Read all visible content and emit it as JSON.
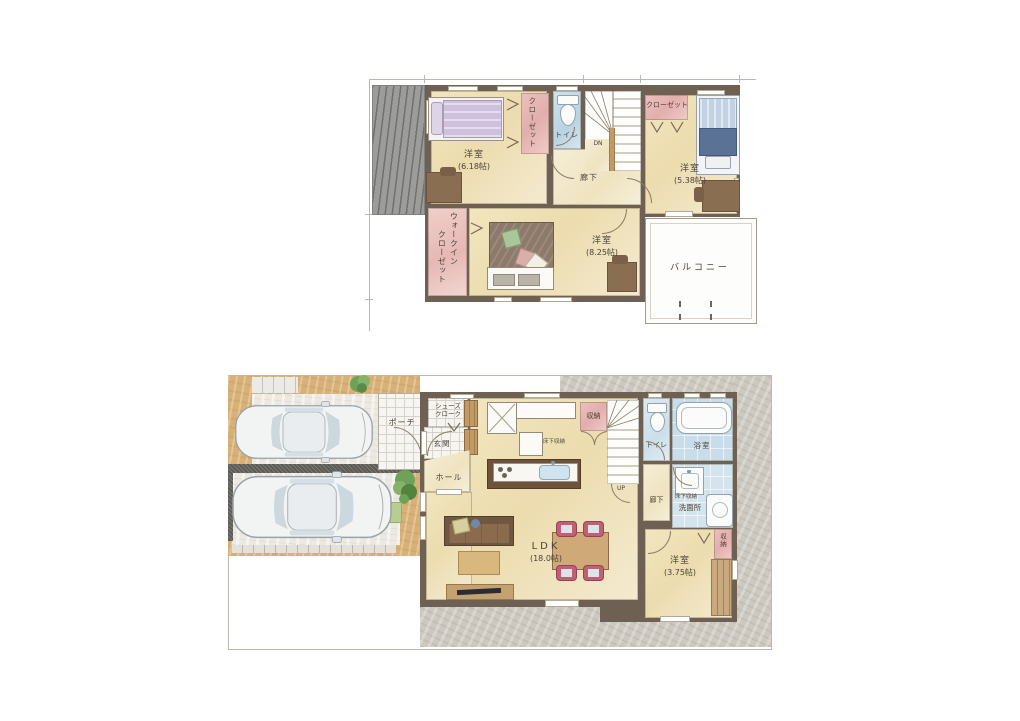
{
  "palette": {
    "wall": "#6e6053",
    "floor": "#f0e3b8",
    "pink": "#e7b8b5",
    "blue": "#c3d9e6",
    "tan": "#d8b178",
    "concrete": "#cdc9c1",
    "wood": "#c9a97e",
    "ink": "#4a4236",
    "chair": "#c06070",
    "balcony": "#fdfdfb"
  },
  "floor2": {
    "rooms": {
      "bedroom618": {
        "label": "洋室",
        "size": "(6.18帖)"
      },
      "closet_left": {
        "label": "クローゼット"
      },
      "toilet": {
        "label": "トイレ"
      },
      "stairs": {
        "label": "DN"
      },
      "hallway": {
        "label": "廊下"
      },
      "closet_right": {
        "label": "クローゼット"
      },
      "bedroom538": {
        "label": "洋室",
        "size": "(5.38帖)"
      },
      "wic": {
        "line1": "ウォークイン",
        "line2": "クローゼット"
      },
      "bedroom825": {
        "label": "洋室",
        "size": "(8.25帖)"
      },
      "balcony": {
        "label": "バルコニー"
      }
    }
  },
  "floor1": {
    "rooms": {
      "porch": {
        "label": "ポーチ"
      },
      "shoes_cloak": {
        "line1": "シューズ",
        "line2": "クローク"
      },
      "genkan": {
        "label": "玄関"
      },
      "hall": {
        "label": "ホール"
      },
      "kitchen_underfloor": {
        "label": "床下収納"
      },
      "storage_stairs": {
        "label": "収納"
      },
      "stairs": {
        "label": "UP"
      },
      "toilet": {
        "label": "トイレ"
      },
      "bath": {
        "label": "浴室"
      },
      "hallway": {
        "label": "廊下"
      },
      "washroom": {
        "label": "洗面所"
      },
      "washroom_underfloor": {
        "label": "床下収納"
      },
      "ldk": {
        "label": "LDK",
        "size": "(18.0帖)"
      },
      "bedroom375": {
        "label": "洋室",
        "size": "(3.75帖)"
      },
      "storage_bedroom": {
        "label": "収納"
      }
    }
  }
}
